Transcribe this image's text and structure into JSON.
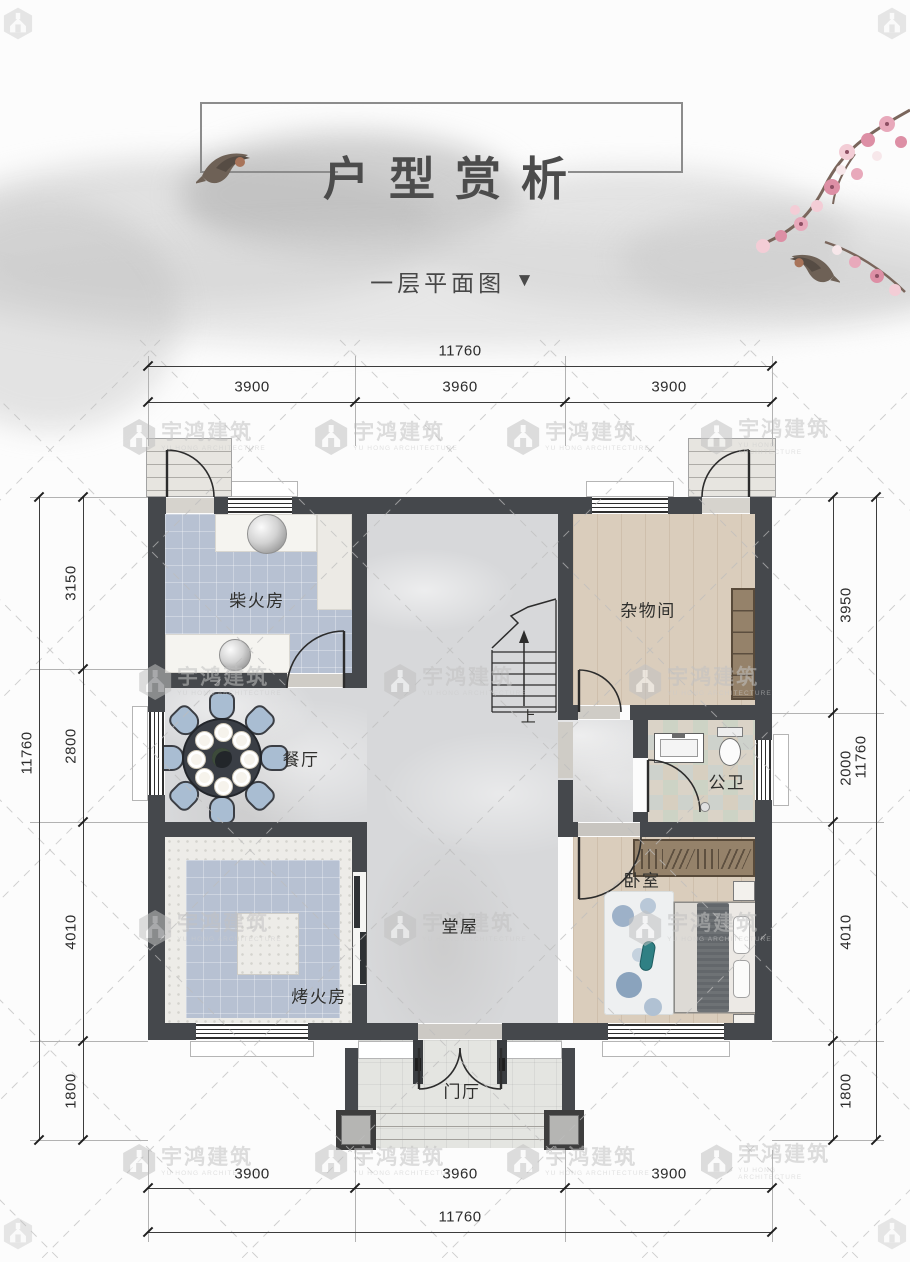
{
  "header": {
    "title": "户型赏析",
    "subtitle": "一层平面图",
    "subtitle_arrow": "▼"
  },
  "watermark": {
    "name": "宇鸿建筑",
    "subtitle": "YU HONG ARCHITECTURE"
  },
  "dims": {
    "top": {
      "overall": "11760",
      "segments": [
        "3900",
        "3960",
        "3900"
      ]
    },
    "bottom": {
      "overall": "11760",
      "segments": [
        "3900",
        "3960",
        "3900"
      ]
    },
    "left": {
      "overall": "11760",
      "segments": [
        "3150",
        "2800",
        "4010",
        "1800"
      ]
    },
    "right": {
      "overall": "11760",
      "segments": [
        "3950",
        "2000",
        "4010",
        "1800"
      ]
    }
  },
  "rooms": {
    "chaihuofang": {
      "label": "柴火房"
    },
    "zawujian": {
      "label": "杂物间"
    },
    "canting": {
      "label": "餐厅"
    },
    "gongwei": {
      "label": "公卫"
    },
    "tangwu": {
      "label": "堂屋"
    },
    "kaohuofang": {
      "label": "烤火房"
    },
    "woshi": {
      "label": "卧室"
    },
    "menting": {
      "label": "门厅"
    }
  },
  "stairs": {
    "up_label": "上"
  },
  "colors": {
    "wall": "#45484c",
    "tile_blue": "#b7c1d2",
    "wood": "#dacdbc",
    "marble": "#d7d8da",
    "blossom_pink": "#e3a0b5",
    "chair_blue": "#a9bdd2"
  }
}
